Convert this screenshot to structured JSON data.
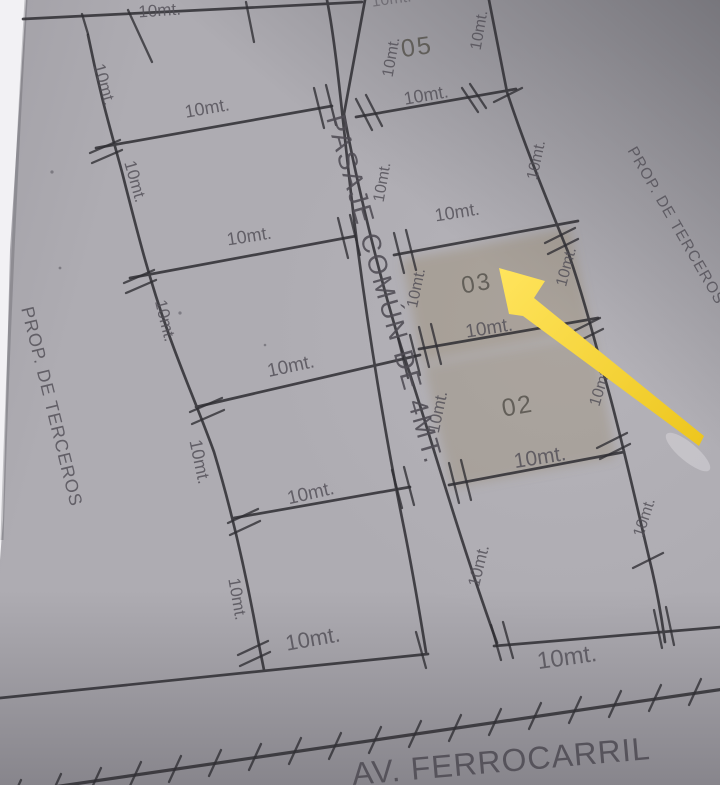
{
  "plan": {
    "passage_label": "PASAJE COMÚN DE 4MT.",
    "avenue_label": "AV. FERROCARRIL",
    "left_property_label": "PROP. DE TERCEROS",
    "right_property_label": "PROP. DE TERCEROS",
    "dimension_label": "10mt.",
    "lot_numbers": {
      "lot05": "05",
      "lot03": "03",
      "lot02": "02"
    },
    "colors": {
      "paper": "#aeacb2",
      "ink": "#2f2e33",
      "label_gray": "#524f57",
      "arrow_yellow": "#f5d327",
      "lot_highlight_tan": "#93805f"
    }
  }
}
